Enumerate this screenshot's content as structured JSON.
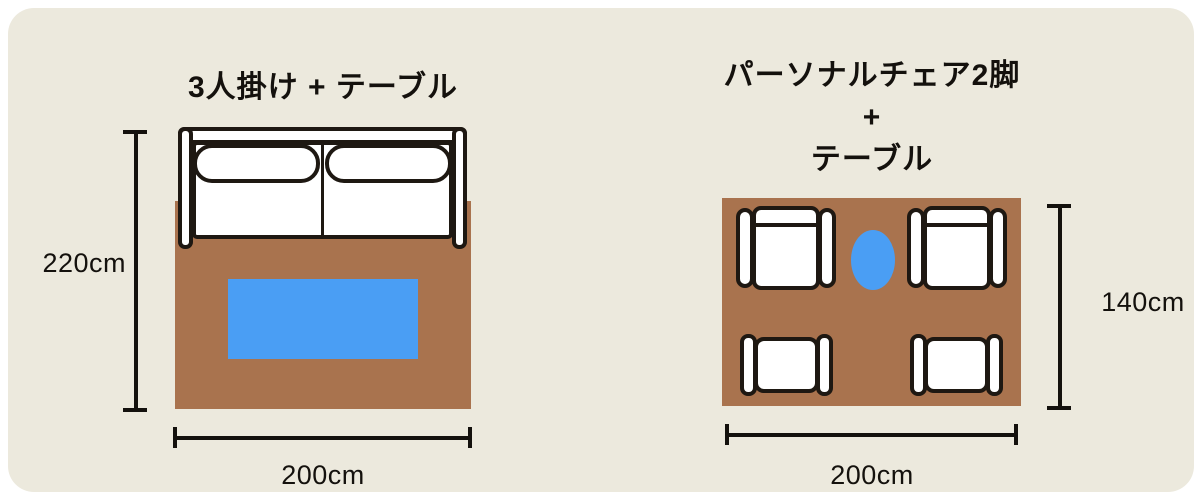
{
  "left_panel": {
    "title": "3人掛け + テーブル",
    "height_dimension": "220cm",
    "width_dimension": "200cm",
    "objects": [
      "sofa-3-seater-top-view",
      "rug",
      "rect-table"
    ]
  },
  "right_panel": {
    "title_line1": "パーソナルチェア2脚",
    "title_plus": "+",
    "title_line2": "テーブル",
    "height_dimension": "140cm",
    "width_dimension": "200cm",
    "objects": [
      "personal-chair-x2-top-view",
      "ottoman-x2-top-view",
      "rug",
      "oval-table"
    ]
  },
  "colors": {
    "page_background": "#ffffff",
    "card_background": "#ece9dd",
    "rug": "#a9734e",
    "table": "#4a9ef4",
    "furniture_fill": "#ffffff",
    "outline": "#1e1812",
    "text": "#14110d"
  }
}
